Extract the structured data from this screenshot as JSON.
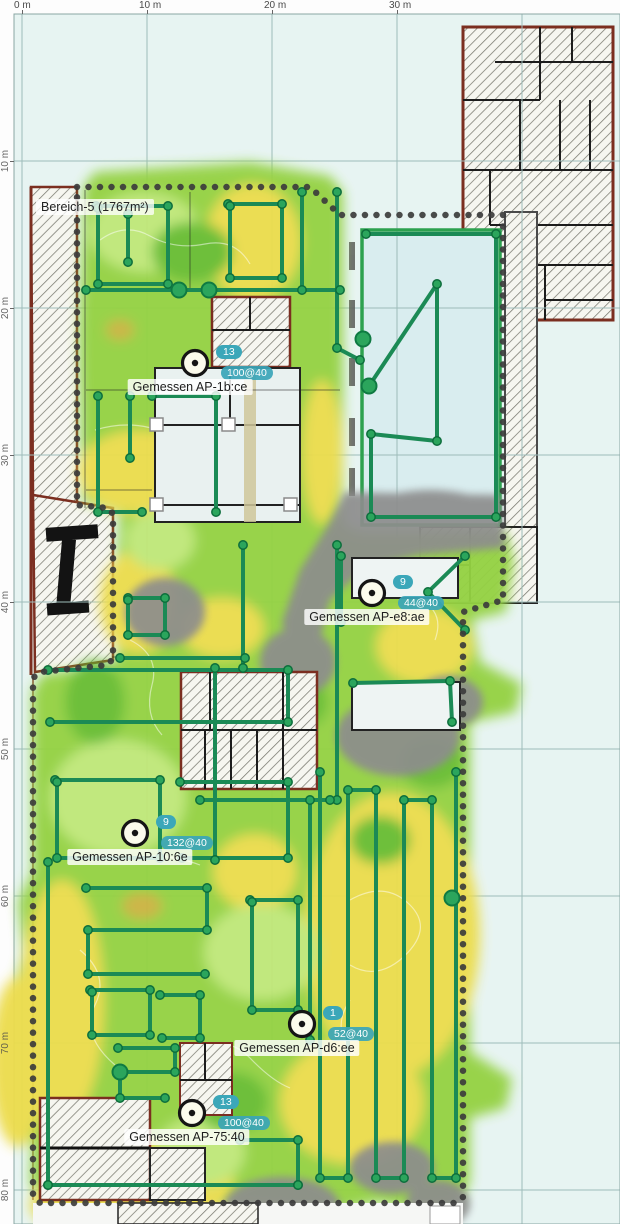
{
  "area_label": "Bereich-5 (1767m²)",
  "rulers": {
    "top": [
      "0 m",
      "10 m",
      "20 m",
      "30 m"
    ],
    "left": [
      "10 m",
      "20 m",
      "30 m",
      "40 m",
      "50 m",
      "60 m",
      "70 m",
      "80 m"
    ]
  },
  "access_points": [
    {
      "name": "Gemessen AP-1b:ce",
      "badge": "13",
      "value": "100@40"
    },
    {
      "name": "Gemessen AP-e8:ae",
      "badge": "9",
      "value": "44@40"
    },
    {
      "name": "Gemessen AP-10:6e",
      "badge": "9",
      "value": "132@40"
    },
    {
      "name": "Gemessen AP-d6:ee",
      "badge": "1",
      "value": "52@40"
    },
    {
      "name": "Gemessen AP-75:40",
      "badge": "13",
      "value": "100@40"
    }
  ],
  "colors": {
    "background": "#e7f4f2",
    "heatmap_strong": "#94d243",
    "heatmap_weak": "#ecdc4b",
    "heatmap_light": "#c0e878",
    "unmeasured_gray": "#8d8d8d",
    "survey_path": "#1b8a55",
    "survey_node": "#2ba55c",
    "badge_teal": "#3ba7b9",
    "boundary_dots": "#3c3c3c",
    "wall_outer_maroon": "#7b2e20"
  }
}
